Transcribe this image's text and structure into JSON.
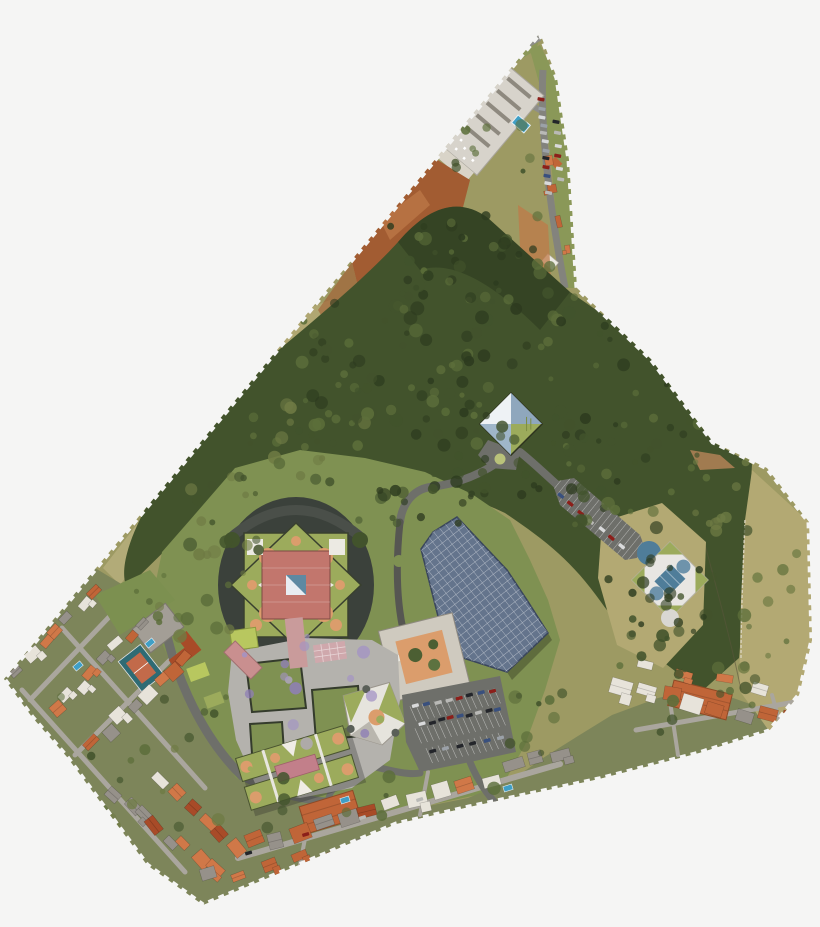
{
  "image": {
    "type": "aerial-orthophoto",
    "subject": "campus-masterplan-site",
    "shape": "irregular-triangular-footprint-on-white"
  },
  "palette": {
    "background": "#f5f5f4",
    "field": "#9d9a63",
    "field_dry": "#b3a973",
    "field_light": "#c2b98a",
    "lawn": "#7f9152",
    "yard": "#7d855a",
    "forest_dark": "#2d3b1f",
    "forest_mid": "#42532c",
    "forest_light": "#5c6e3a",
    "forest_olive": "#6f7b44",
    "dirt": "#a25c32",
    "dirt_light": "#bf7a48",
    "concrete": "#d9d4c8",
    "road_dark": "#565652",
    "road_mid": "#6e6f6a",
    "road_light": "#aaa69e",
    "paving": "#b4b2ad",
    "paving_pink": "#c99b9b",
    "roof_orange": "#c06538",
    "roof_terracotta": "#d07848",
    "roof_red": "#a84b28",
    "roof_white": "#e7e3da",
    "roof_gray": "#96918a",
    "campus_green": "#9cab5c",
    "campus_lime": "#b8c75f",
    "campus_red": "#c2766d",
    "accent_orange": "#db9d6c",
    "white_struct": "#eceae3",
    "solar": "#64748c",
    "solar_edge": "#39455c",
    "sky_blue": "#8fa7bd",
    "pale_blue": "#dfe7ee",
    "steel_blue": "#4f7d99",
    "water": "#3f9fc6",
    "purple_a": "#a393c4",
    "purple_b": "#8f7fb5",
    "purple_c": "#b9aad6",
    "court_teal": "#2e6b74",
    "court_red": "#c26a4a",
    "shadow": "#3b413b",
    "strip_grass": "#8a9858"
  },
  "seed": 12,
  "scatter": {
    "trees": [
      {
        "x": 390,
        "y": 215,
        "w": 160,
        "h": 95,
        "count": 45,
        "colors": [
          "forest_dark",
          "forest_mid",
          "forest_light"
        ]
      },
      {
        "x": 300,
        "y": 295,
        "w": 190,
        "h": 140,
        "count": 55,
        "colors": [
          "forest_dark",
          "forest_mid",
          "forest_light"
        ]
      },
      {
        "x": 460,
        "y": 295,
        "w": 230,
        "h": 150,
        "count": 60,
        "colors": [
          "forest_dark",
          "forest_mid",
          "forest_light"
        ]
      },
      {
        "x": 560,
        "y": 420,
        "w": 150,
        "h": 110,
        "count": 35,
        "colors": [
          "forest_dark",
          "forest_mid",
          "forest_light"
        ]
      },
      {
        "x": 250,
        "y": 385,
        "w": 130,
        "h": 100,
        "count": 28,
        "colors": [
          "forest_mid",
          "forest_light",
          "forest_olive"
        ]
      },
      {
        "x": 600,
        "y": 555,
        "w": 115,
        "h": 100,
        "count": 25,
        "colors": [
          "forest_dark",
          "forest_mid"
        ]
      },
      {
        "x": 180,
        "y": 475,
        "w": 100,
        "h": 80,
        "count": 18,
        "colors": [
          "forest_mid",
          "forest_olive"
        ]
      },
      {
        "x": 430,
        "y": 430,
        "w": 110,
        "h": 70,
        "count": 18,
        "colors": [
          "forest_dark",
          "forest_mid"
        ]
      },
      {
        "x": 695,
        "y": 455,
        "w": 60,
        "h": 90,
        "count": 12,
        "colors": [
          "forest_mid",
          "forest_olive"
        ]
      },
      {
        "x": 240,
        "y": 635,
        "w": 150,
        "h": 115,
        "count": 14,
        "colors": [
          "purple_a",
          "purple_b",
          "purple_c"
        ]
      },
      {
        "x": 60,
        "y": 690,
        "w": 170,
        "h": 150,
        "count": 20,
        "colors": [
          "forest_mid",
          "forest_light",
          "forest_olive"
        ]
      },
      {
        "x": 255,
        "y": 770,
        "w": 300,
        "h": 80,
        "count": 18,
        "colors": [
          "forest_mid",
          "forest_light"
        ]
      },
      {
        "x": 610,
        "y": 655,
        "w": 170,
        "h": 80,
        "count": 14,
        "colors": [
          "forest_mid",
          "forest_light"
        ]
      },
      {
        "x": 740,
        "y": 540,
        "w": 60,
        "h": 140,
        "count": 10,
        "colors": [
          "forest_olive",
          "forest_light"
        ]
      },
      {
        "x": 440,
        "y": 120,
        "w": 90,
        "h": 60,
        "count": 10,
        "colors": [
          "forest_mid",
          "forest_light"
        ]
      },
      {
        "x": 120,
        "y": 560,
        "w": 130,
        "h": 90,
        "count": 14,
        "colors": [
          "forest_olive",
          "forest_light"
        ]
      },
      {
        "x": 330,
        "y": 465,
        "w": 160,
        "h": 60,
        "count": 16,
        "colors": [
          "forest_dark",
          "forest_mid"
        ]
      },
      {
        "x": 505,
        "y": 690,
        "w": 60,
        "h": 70,
        "count": 10,
        "colors": [
          "forest_mid",
          "forest_light"
        ]
      }
    ]
  },
  "residential": {
    "roof_colors": [
      "roof_orange",
      "roof_terracotta",
      "roof_white",
      "roof_gray",
      "roof_red"
    ],
    "clusters": [
      {
        "x1": 20,
        "y1": 668,
        "x2": 96,
        "y2": 592,
        "count": 7,
        "size": 13,
        "angle": -45
      },
      {
        "x1": 58,
        "y1": 706,
        "x2": 140,
        "y2": 622,
        "count": 8,
        "size": 13,
        "angle": -45
      },
      {
        "x1": 96,
        "y1": 744,
        "x2": 185,
        "y2": 655,
        "count": 8,
        "size": 14,
        "angle": -45
      },
      {
        "x1": 118,
        "y1": 792,
        "x2": 212,
        "y2": 872,
        "count": 8,
        "size": 14,
        "angle": 47
      },
      {
        "x1": 160,
        "y1": 780,
        "x2": 235,
        "y2": 850,
        "count": 6,
        "size": 13,
        "angle": 47
      },
      {
        "x1": 252,
        "y1": 844,
        "x2": 560,
        "y2": 756,
        "count": 14,
        "size": 16,
        "angle": -17
      },
      {
        "x1": 330,
        "y1": 856,
        "x2": 520,
        "y2": 800,
        "count": 8,
        "size": 13,
        "angle": -17
      },
      {
        "x1": 210,
        "y1": 880,
        "x2": 300,
        "y2": 852,
        "count": 4,
        "size": 12,
        "angle": -20
      },
      {
        "x1": 622,
        "y1": 690,
        "x2": 790,
        "y2": 722,
        "count": 8,
        "size": 17,
        "angle": 14
      },
      {
        "x1": 648,
        "y1": 664,
        "x2": 760,
        "y2": 686,
        "count": 4,
        "size": 13,
        "angle": 14
      },
      {
        "x1": 552,
        "y1": 160,
        "x2": 563,
        "y2": 252,
        "count": 4,
        "size": 9,
        "angle": 80
      }
    ],
    "pools": [
      {
        "x": 78,
        "y": 666,
        "a": -40
      },
      {
        "x": 150,
        "y": 643,
        "a": -40
      },
      {
        "x": 345,
        "y": 800,
        "a": -17
      },
      {
        "x": 508,
        "y": 788,
        "a": -17
      }
    ]
  },
  "cars": {
    "colors": [
      "#23252a",
      "#8c1f1a",
      "#d9dadb",
      "#9ba1a8",
      "#39507e",
      "#b9b9b6"
    ],
    "rows": [
      {
        "x1": 541,
        "y1": 100,
        "x2": 549,
        "y2": 192,
        "count": 12,
        "angle": 100
      },
      {
        "x1": 556,
        "y1": 122,
        "x2": 560,
        "y2": 180,
        "count": 6,
        "angle": 100
      },
      {
        "x1": 560,
        "y1": 496,
        "x2": 622,
        "y2": 547,
        "count": 7,
        "angle": 129
      },
      {
        "x1": 416,
        "y1": 706,
        "x2": 492,
        "y2": 691,
        "count": 8,
        "angle": 75
      },
      {
        "x1": 422,
        "y1": 724,
        "x2": 498,
        "y2": 709,
        "count": 9,
        "angle": 75
      },
      {
        "x1": 432,
        "y1": 752,
        "x2": 500,
        "y2": 738,
        "count": 6,
        "angle": 75
      },
      {
        "x1": 248,
        "y1": 852,
        "x2": 420,
        "y2": 800,
        "count": 4,
        "angle": 73
      }
    ]
  }
}
